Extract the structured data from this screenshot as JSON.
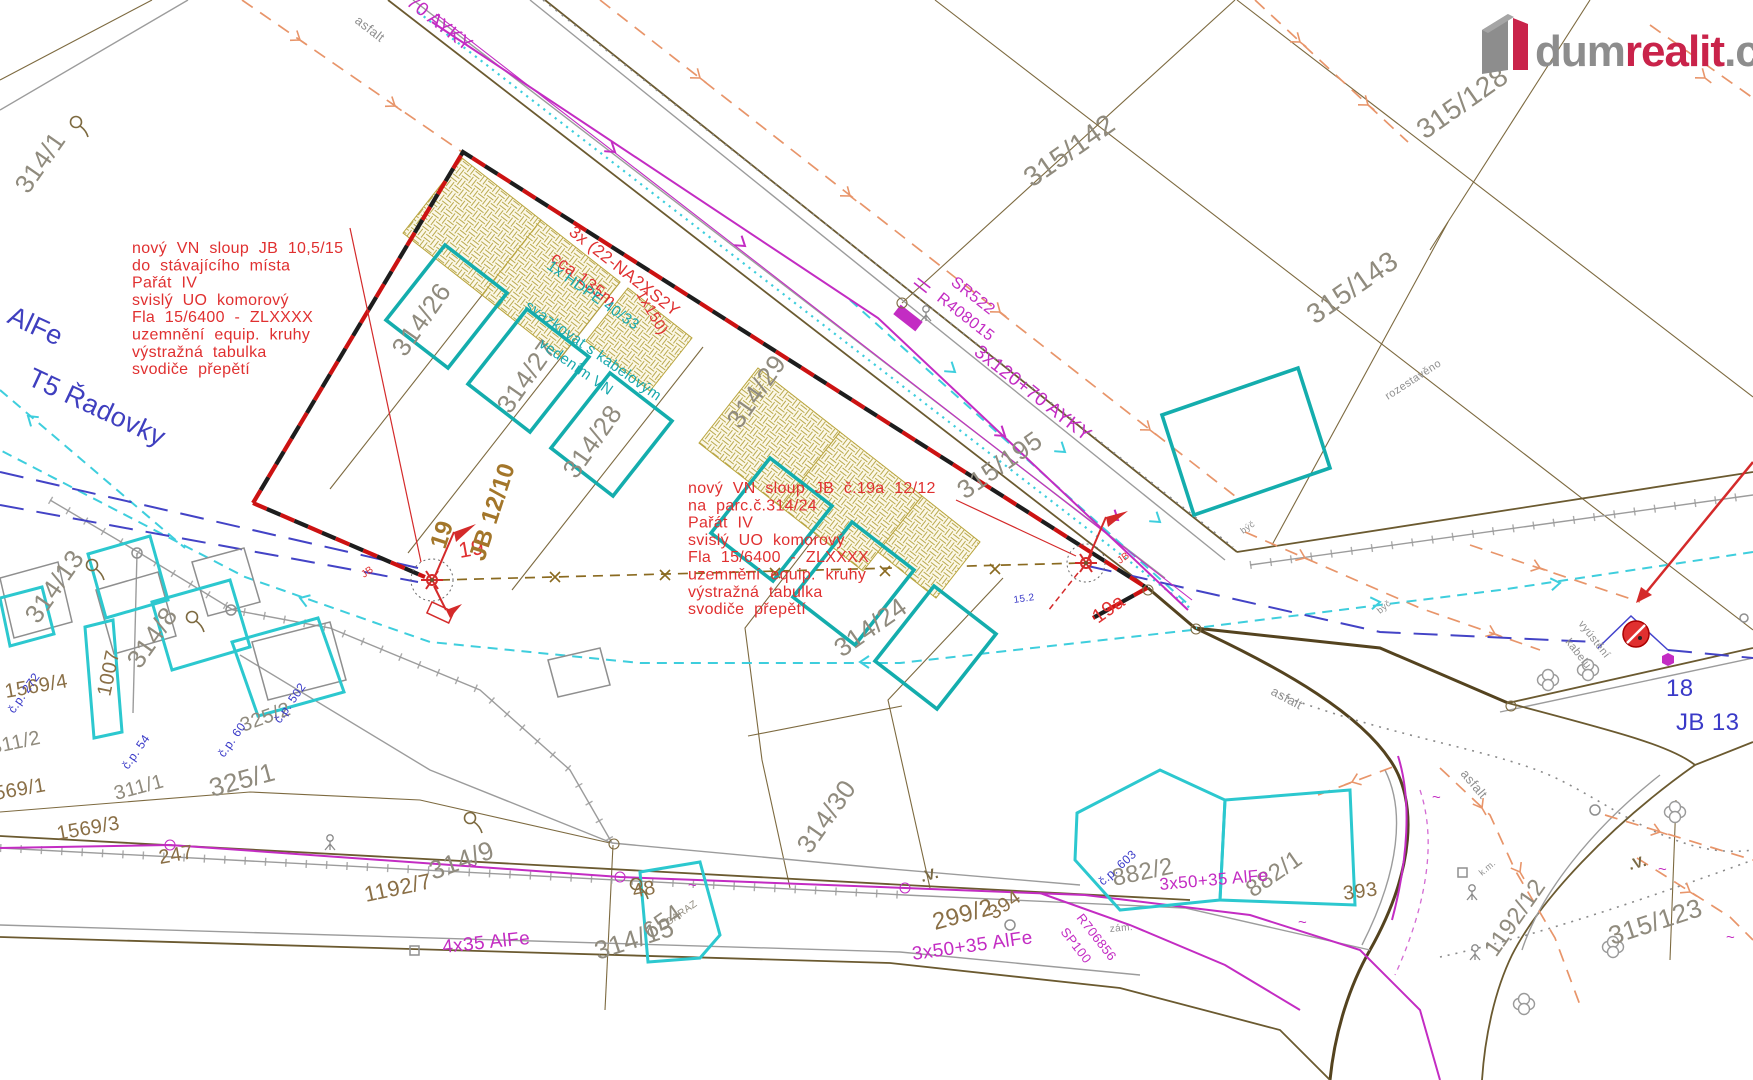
{
  "logo": {
    "brand_gray": "dum",
    "brand_red": "realit",
    "brand_tld": ".cz"
  },
  "colors": {
    "annotation_red": "#e03030",
    "planned_building_teal": "#14adad",
    "cable_magenta": "#c32cc3",
    "flow_cyan": "#3ecedd",
    "navy_line": "#4343c6",
    "fence_orange": "#e8956a",
    "parcel_brown": "#7d6a40",
    "parcel_label_gray": "#908b7e",
    "logo_red": "#c9234a",
    "logo_gray": "#8d8d8d"
  },
  "annotations": {
    "pole19_note": {
      "lines": [
        "nový VN sloup JB 10,5/15",
        "do stávajícího místa",
        "Pařát IV",
        "svislý UO komorový",
        "Fla 15/6400 - ZLXXXX",
        "uzemnění equip. kruhy",
        "výstražná tabulka",
        "svodiče přepětí"
      ]
    },
    "pole19a_note": {
      "lines": [
        "nový VN sloup JB č.19a 12/12",
        "na parc.č.314/24",
        "Pařát IV",
        "svislý UO komorový",
        "Fla 15/6400 - ZLXXXX",
        "uzemnění equip. kruhy",
        "výstražná tabulka",
        "svodiče přepětí"
      ]
    }
  },
  "map": {
    "labels": [
      {
        "t": "314/1",
        "x": 28,
        "y": 195,
        "r": -55,
        "s": 26,
        "c": "g",
        "n": "parcel-314-1"
      },
      {
        "t": "314/26",
        "x": 405,
        "y": 358,
        "r": -55,
        "s": 26,
        "c": "g",
        "n": "parcel-314-26"
      },
      {
        "t": "314/27",
        "x": 510,
        "y": 415,
        "r": -55,
        "s": 26,
        "c": "g",
        "n": "parcel-314-27"
      },
      {
        "t": "314/28",
        "x": 576,
        "y": 480,
        "r": -55,
        "s": 26,
        "c": "g",
        "n": "parcel-314-28"
      },
      {
        "t": "314/29",
        "x": 740,
        "y": 430,
        "r": -55,
        "s": 26,
        "c": "g",
        "n": "parcel-314-29"
      },
      {
        "t": "314/24",
        "x": 842,
        "y": 658,
        "r": -35,
        "s": 26,
        "c": "g",
        "n": "parcel-314-24"
      },
      {
        "t": "314/30",
        "x": 810,
        "y": 855,
        "r": -55,
        "s": 26,
        "c": "g",
        "n": "parcel-314-30"
      },
      {
        "t": "314/13",
        "x": 38,
        "y": 625,
        "r": -55,
        "s": 26,
        "c": "g",
        "n": "parcel-314-13"
      },
      {
        "t": "314/8",
        "x": 140,
        "y": 670,
        "r": -55,
        "s": 26,
        "c": "g",
        "n": "parcel-314-8"
      },
      {
        "t": "314/9",
        "x": 433,
        "y": 880,
        "r": -20,
        "s": 26,
        "c": "g",
        "n": "parcel-314-9"
      },
      {
        "t": "314/15",
        "x": 598,
        "y": 960,
        "r": -18,
        "s": 26,
        "c": "g",
        "n": "parcel-314-15"
      },
      {
        "t": "315/142",
        "x": 1032,
        "y": 188,
        "r": -35,
        "s": 28,
        "c": "g",
        "n": "parcel-315-142"
      },
      {
        "t": "315/128",
        "x": 1425,
        "y": 140,
        "r": -35,
        "s": 28,
        "c": "g",
        "n": "parcel-315-128"
      },
      {
        "t": "315/143",
        "x": 1315,
        "y": 325,
        "r": -35,
        "s": 28,
        "c": "g",
        "n": "parcel-315-143"
      },
      {
        "t": "315/195",
        "x": 965,
        "y": 500,
        "r": -35,
        "s": 26,
        "c": "g",
        "n": "parcel-315-195"
      },
      {
        "t": "315/123",
        "x": 1612,
        "y": 945,
        "r": -18,
        "s": 26,
        "c": "g",
        "n": "parcel-315-123"
      },
      {
        "t": "1192/12",
        "x": 1496,
        "y": 958,
        "r": -55,
        "s": 24,
        "c": "g",
        "n": "parcel-1192-12"
      },
      {
        "t": "882/2",
        "x": 1114,
        "y": 886,
        "r": -12,
        "s": 24,
        "c": "g",
        "n": "parcel-882-2"
      },
      {
        "t": "882/1",
        "x": 1253,
        "y": 898,
        "r": -35,
        "s": 24,
        "c": "g",
        "n": "parcel-882-1"
      },
      {
        "t": "325/2",
        "x": 243,
        "y": 732,
        "r": -20,
        "s": 20,
        "c": "g",
        "n": "parcel-325-2"
      },
      {
        "t": "325/1",
        "x": 212,
        "y": 797,
        "r": -15,
        "s": 26,
        "c": "g",
        "n": "parcel-325-1"
      },
      {
        "t": "311/2",
        "x": -8,
        "y": 754,
        "r": -12,
        "s": 20,
        "c": "g",
        "n": "parcel-311-2"
      },
      {
        "t": "311/1",
        "x": 116,
        "y": 800,
        "r": -15,
        "s": 20,
        "c": "g",
        "n": "parcel-311-1"
      },
      {
        "t": "654",
        "x": 650,
        "y": 940,
        "r": -35,
        "s": 24,
        "c": "g",
        "n": "parcel-654"
      },
      {
        "t": "GARAZ",
        "x": 668,
        "y": 926,
        "r": -35,
        "s": 10,
        "c": "g",
        "n": "garage-label"
      },
      {
        "t": "1192/7",
        "x": 366,
        "y": 902,
        "r": -12,
        "s": 22,
        "c": "br",
        "n": "parcel-1192-7"
      },
      {
        "t": "299/2",
        "x": 935,
        "y": 930,
        "r": -15,
        "s": 24,
        "c": "br",
        "n": "parcel-299-2"
      },
      {
        "t": "1007",
        "x": 110,
        "y": 697,
        "r": -78,
        "s": 20,
        "c": "br",
        "n": "parcel-1007"
      },
      {
        "t": "1569/4",
        "x": 6,
        "y": 698,
        "r": -10,
        "s": 20,
        "c": "br",
        "n": "parcel-1569-4"
      },
      {
        "t": "1569/3",
        "x": 58,
        "y": 840,
        "r": -10,
        "s": 20,
        "c": "br",
        "n": "parcel-1569-3"
      },
      {
        "t": "1569/1",
        "x": -16,
        "y": 802,
        "r": -10,
        "s": 20,
        "c": "br",
        "n": "parcel-1569-1"
      },
      {
        "t": "247",
        "x": 160,
        "y": 864,
        "r": -10,
        "s": 20,
        "c": "br",
        "n": "parcel-247"
      },
      {
        "t": "48",
        "x": 634,
        "y": 898,
        "r": -12,
        "s": 20,
        "c": "br",
        "n": "parcel-48"
      },
      {
        "t": "394",
        "x": 994,
        "y": 920,
        "r": -35,
        "s": 20,
        "c": "br",
        "n": "parcel-394"
      },
      {
        "t": "393",
        "x": 1344,
        "y": 900,
        "r": -8,
        "s": 20,
        "c": "br",
        "n": "parcel-393"
      },
      {
        "t": "č.p. 272",
        "x": 14,
        "y": 714,
        "r": -55,
        "s": 12,
        "c": "bl",
        "n": "house-cp-272"
      },
      {
        "t": "č.p. 502",
        "x": 280,
        "y": 724,
        "r": -55,
        "s": 12,
        "c": "bl",
        "n": "house-cp-502"
      },
      {
        "t": "č.p. 54",
        "x": 128,
        "y": 770,
        "r": -55,
        "s": 12,
        "c": "bl",
        "n": "house-cp-54"
      },
      {
        "t": "č.p. 60",
        "x": 224,
        "y": 758,
        "r": -55,
        "s": 12,
        "c": "bl",
        "n": "house-cp-60"
      },
      {
        "t": "č.p. 603",
        "x": 1103,
        "y": 886,
        "r": -42,
        "s": 12,
        "c": "bl",
        "n": "house-cp-603"
      },
      {
        "t": "18",
        "x": 1666,
        "y": 696,
        "r": 0,
        "s": 24,
        "c": "bl",
        "n": "pole-18-label"
      },
      {
        "t": "JB 13",
        "x": 1676,
        "y": 730,
        "r": 0,
        "s": 24,
        "c": "bl",
        "n": "pole-jb13-label"
      },
      {
        "t": "15.2",
        "x": 1014,
        "y": 603,
        "r": -8,
        "s": 10,
        "c": "bl",
        "n": "distance-15-2"
      },
      {
        "t": "AlFe",
        "x": 6,
        "y": 322,
        "r": 25,
        "s": 27,
        "c": "nv",
        "n": "line-alfe-label"
      },
      {
        "t": "T5 Řadovky",
        "x": 26,
        "y": 384,
        "r": 25,
        "s": 27,
        "c": "nv",
        "n": "t5-radovky-label"
      },
      {
        "t": "3x120+70 AYKY",
        "x": 354,
        "y": -36,
        "r": 38,
        "s": 19,
        "c": "mg",
        "n": "cable-ayky-top"
      },
      {
        "t": "3x120+70 AYKY",
        "x": 973,
        "y": 354,
        "r": 38,
        "s": 19,
        "c": "mg",
        "n": "cable-ayky-mid"
      },
      {
        "t": "SR522",
        "x": 950,
        "y": 284,
        "r": 38,
        "s": 16,
        "c": "mg",
        "n": "sr522-label"
      },
      {
        "t": "R408015",
        "x": 936,
        "y": 300,
        "r": 38,
        "s": 16,
        "c": "mg",
        "n": "r408015-label"
      },
      {
        "t": "4x35 AlFe",
        "x": 443,
        "y": 953,
        "r": -6,
        "s": 19,
        "c": "mg",
        "n": "cable-4x35-alfe"
      },
      {
        "t": "3x50+35 AlFe",
        "x": 913,
        "y": 960,
        "r": -8,
        "s": 19,
        "c": "mg",
        "n": "cable-3x50-alfe-a"
      },
      {
        "t": "3x50+35 AlFe",
        "x": 1160,
        "y": 890,
        "r": -5,
        "s": 17,
        "c": "mg",
        "n": "cable-3x50-alfe-b"
      },
      {
        "t": "R706856",
        "x": 1076,
        "y": 918,
        "r": 52,
        "s": 13,
        "c": "mg",
        "n": "r706856-label"
      },
      {
        "t": "SP100",
        "x": 1060,
        "y": 932,
        "r": 52,
        "s": 13,
        "c": "mg",
        "n": "sp100-label"
      },
      {
        "t": "3x (22-NA2XS2Y",
        "x": 568,
        "y": 234,
        "r": 38,
        "s": 17,
        "c": "rd",
        "n": "cable-na2xs2y-label"
      },
      {
        "t": "cca 135m",
        "x": 550,
        "y": 260,
        "r": 38,
        "s": 17,
        "c": "rd",
        "n": "cable-length-label"
      },
      {
        "t": "1x150)",
        "x": 636,
        "y": 294,
        "r": 60,
        "s": 15,
        "c": "rd",
        "n": "cable-1x150-label"
      },
      {
        "t": "19",
        "x": 460,
        "y": 558,
        "r": -10,
        "s": 22,
        "c": "rd",
        "n": "pole-19-number"
      },
      {
        "t": "19a",
        "x": 1098,
        "y": 624,
        "r": -35,
        "s": 20,
        "c": "rd",
        "n": "pole-19a-number"
      },
      {
        "t": "JB",
        "x": 364,
        "y": 578,
        "r": -35,
        "s": 10,
        "c": "rd",
        "n": "pole-19-jb"
      },
      {
        "t": "JB",
        "x": 1120,
        "y": 564,
        "r": -35,
        "s": 10,
        "c": "rd",
        "n": "pole-19a-jb"
      },
      {
        "t": "1x HDPE 40/33",
        "x": 546,
        "y": 268,
        "r": 35,
        "s": 15,
        "c": "tl",
        "n": "hdpe-label"
      },
      {
        "t": "svazkovat s kabelovým",
        "x": 524,
        "y": 308,
        "r": 35,
        "s": 15,
        "c": "tl",
        "n": "svazkovat-label-1"
      },
      {
        "t": "vedením VN",
        "x": 538,
        "y": 346,
        "r": 35,
        "s": 15,
        "c": "tl",
        "n": "svazkovat-label-2"
      },
      {
        "t": "19",
        "x": 445,
        "y": 550,
        "r": -72,
        "s": 24,
        "c": "bw",
        "n": "pole-19-jb1210-a"
      },
      {
        "t": "JB 12/10",
        "x": 484,
        "y": 562,
        "r": -72,
        "s": 24,
        "c": "bw",
        "n": "pole-19-jb1210-b"
      },
      {
        "t": "asfalt",
        "x": 354,
        "y": 22,
        "r": 38,
        "s": 13,
        "c": "sm",
        "n": "surface-asfalt-top"
      },
      {
        "t": "asfalt",
        "x": 1270,
        "y": 694,
        "r": 28,
        "s": 13,
        "c": "sm",
        "n": "surface-asfalt-right"
      },
      {
        "t": "asfalt",
        "x": 1460,
        "y": 774,
        "r": 50,
        "s": 13,
        "c": "sm",
        "n": "surface-asfalt-curve"
      },
      {
        "t": "rozestavěno",
        "x": 1388,
        "y": 400,
        "r": -33,
        "s": 11,
        "c": "sm",
        "n": "rozestaveno-label"
      },
      {
        "t": "vyústění",
        "x": 1578,
        "y": 624,
        "r": 52,
        "s": 11,
        "c": "sm",
        "n": "vyusteni-label-1"
      },
      {
        "t": "kabelu",
        "x": 1565,
        "y": 642,
        "r": 52,
        "s": 11,
        "c": "sm",
        "n": "vyusteni-label-2"
      },
      {
        "t": "býč",
        "x": 1380,
        "y": 614,
        "r": -40,
        "s": 9,
        "c": "sm",
        "n": "byc-label-1"
      },
      {
        "t": "býč",
        "x": 1243,
        "y": 534,
        "r": -35,
        "s": 9,
        "c": "sm",
        "n": "byc-label-2"
      },
      {
        "t": "k.m.",
        "x": 1482,
        "y": 876,
        "r": -40,
        "s": 9,
        "c": "sm",
        "n": "km-label"
      },
      {
        "t": "zám.",
        "x": 1110,
        "y": 932,
        "r": -5,
        "s": 10,
        "c": "sm",
        "n": "zam-label"
      },
      {
        "t": ".V.",
        "x": 922,
        "y": 882,
        "r": -15,
        "s": 15,
        "c": "vsym",
        "n": "landuse-symbol-299"
      },
      {
        "t": ".V.",
        "x": 1630,
        "y": 870,
        "r": -15,
        "s": 15,
        "c": "vsym",
        "n": "landuse-symbol-315"
      },
      {
        "t": "~",
        "x": 1432,
        "y": 802,
        "r": 0,
        "s": 15,
        "c": "mg",
        "n": "cable-mark"
      },
      {
        "t": "~",
        "x": 1298,
        "y": 927,
        "r": 0,
        "s": 15,
        "c": "mg",
        "n": "cable-mark"
      },
      {
        "t": "~",
        "x": 688,
        "y": 890,
        "r": 0,
        "s": 15,
        "c": "mg",
        "n": "cable-mark"
      },
      {
        "t": "~",
        "x": 468,
        "y": 870,
        "r": 0,
        "s": 15,
        "c": "mg",
        "n": "cable-mark"
      },
      {
        "t": "~",
        "x": 1658,
        "y": 874,
        "r": 0,
        "s": 15,
        "c": "mg",
        "n": "cable-mark"
      },
      {
        "t": "~",
        "x": 1726,
        "y": 942,
        "r": 0,
        "s": 15,
        "c": "mg",
        "n": "cable-mark"
      }
    ]
  }
}
